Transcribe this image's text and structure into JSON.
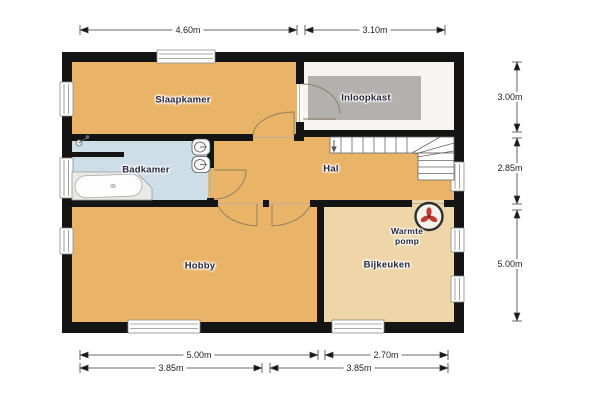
{
  "colors": {
    "room_orange": "#EAB468",
    "room_peach": "#EFD6A8",
    "room_blue": "#CDDEE9",
    "room_white": "#F7F5F1",
    "closet_gray": "#B3B1AE",
    "wall_black": "#141414",
    "heat_pump_red": "#C13B33"
  },
  "rooms": {
    "slaapkamer": "Slaapkamer",
    "inloopkast": "Inloopkast",
    "badkamer": "Badkamer",
    "hal": "Hal",
    "hobby": "Hobby",
    "bijkeuken": "Bijkeuken",
    "warmte_pomp": "Warmte pomp"
  },
  "dimensions": {
    "top": [
      "4.60m",
      "3.10m"
    ],
    "right": [
      "3.00m",
      "2.85m",
      "5.00m"
    ],
    "bottom_row1": [
      "5.00m",
      "2.70m"
    ],
    "bottom_row2": [
      "3.85m",
      "3.85m"
    ]
  }
}
